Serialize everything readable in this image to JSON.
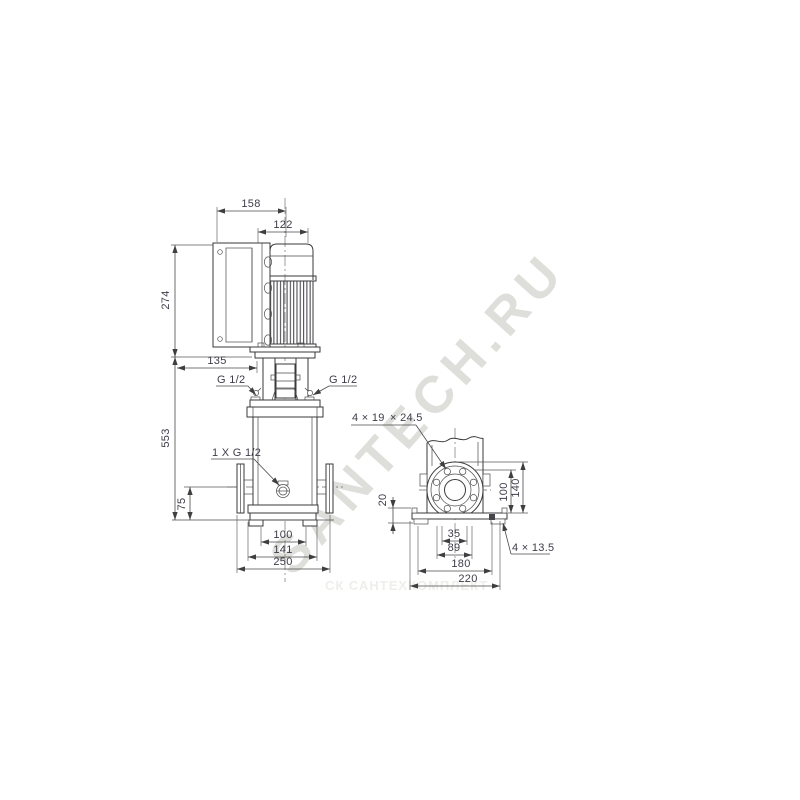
{
  "colors": {
    "line": "#3a3a3a",
    "dim_text": "#3d3d49",
    "watermark": "#dededa"
  },
  "watermarks": {
    "large": "SANTECH.RU",
    "small": "СК САНТЕХКОМПЛЕКТ"
  },
  "front_view": {
    "dims": {
      "top_width": "158",
      "motor_width": "122",
      "motor_height": "274",
      "box_offset": "135",
      "pump_height": "553",
      "port_height": "75",
      "base_inner": "100",
      "base_mid": "141",
      "port_to_port": "250"
    },
    "labels": {
      "port_left": "G 1/2",
      "port_right": "G 1/2",
      "drain": "1 X G 1/2"
    }
  },
  "side_view": {
    "dims": {
      "plate_height": "20",
      "flange_center_height": "100",
      "flange_top_height": "140",
      "leg_inner": "35",
      "leg_outer": "89",
      "base_length": "180",
      "plate_length": "220"
    },
    "labels": {
      "flange_holes_a": "4 × 19",
      "flange_holes_b": "× 24.5",
      "base_holes": "4 × 13.5"
    }
  }
}
